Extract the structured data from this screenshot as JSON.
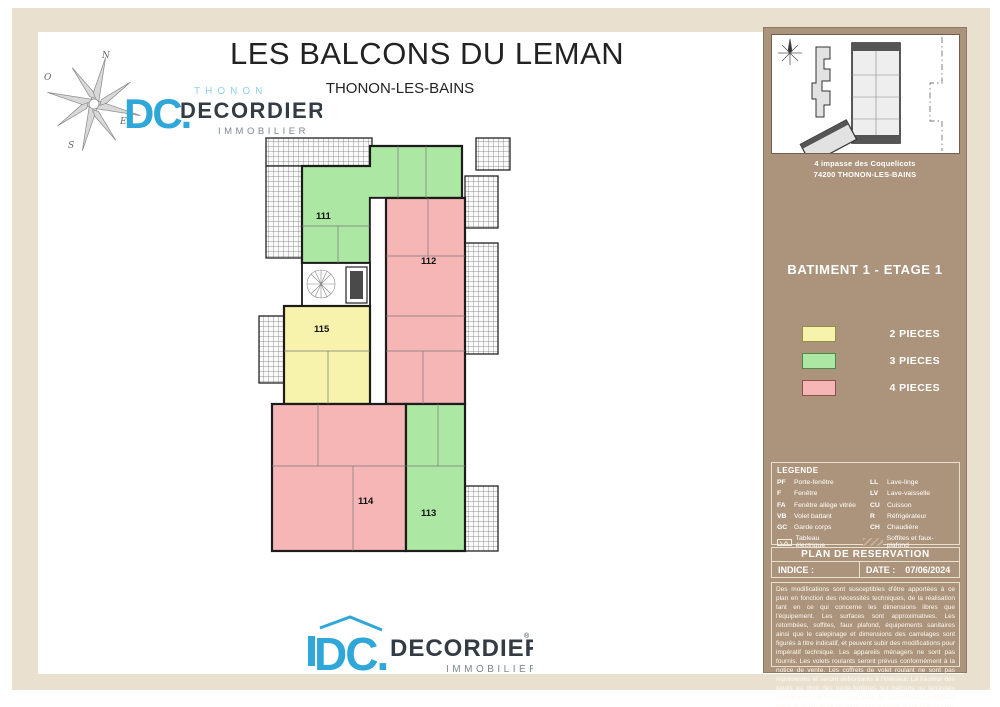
{
  "page": {
    "title": "LES BALCONS DU LEMAN",
    "subtitle": "THONON-LES-BAINS"
  },
  "brand": {
    "monogram": "DC.",
    "city": "THONON",
    "name": "DECORDIER",
    "registered": "®",
    "tagline": "IMMOBILIER",
    "compass": {
      "n": "N",
      "o": "O",
      "e": "E",
      "s": "S"
    },
    "blue": "#2fa7d9",
    "light_blue": "#8fd2e8",
    "dark": "#333c44",
    "gray": "#7d8790"
  },
  "sidebar": {
    "address_line1": "4 impasse des Coquelicots",
    "address_line2": "74200 THONON-LES-BAINS",
    "building_title": "BATIMENT 1 - ETAGE 1",
    "unit_types": [
      {
        "label": "2 PIECES",
        "color": "#f7f3ac",
        "border": "#8f8f45"
      },
      {
        "label": "3 PIECES",
        "color": "#ace8a4",
        "border": "#4d8a45"
      },
      {
        "label": "4 PIECES",
        "color": "#f6b6b6",
        "border": "#8f4d4d"
      }
    ],
    "legende": {
      "title": "LEGENDE",
      "items_left": [
        {
          "abbr": "PF",
          "label": "Porte-fenêtre"
        },
        {
          "abbr": "F",
          "label": "Fenêtre"
        },
        {
          "abbr": "FA",
          "label": "Fenêtre allège vitrée"
        },
        {
          "abbr": "VB",
          "label": "Volet battant"
        },
        {
          "abbr": "GC",
          "label": "Garde corps"
        }
      ],
      "items_right": [
        {
          "abbr": "LL",
          "label": "Lave-linge"
        },
        {
          "abbr": "LV",
          "label": "Lave-vaisselle"
        },
        {
          "abbr": "CU",
          "label": "Cuisson"
        },
        {
          "abbr": "R",
          "label": "Réfrigérateur"
        },
        {
          "abbr": "CH",
          "label": "Chaudière"
        }
      ],
      "elec_label": "Tableau électrique",
      "soffit_label": "Soffites et faux-plafond"
    },
    "reservation_title": "PLAN DE RESERVATION",
    "indice_label": "INDICE :",
    "date_label": "DATE :",
    "date_value": "07/06/2024",
    "disclaimer": "Des modifications sont susceptibles d'être apportées à ce plan en fonction des nécessités techniques, de la réalisation tant en ce qui concerne les dimensions libres que l'équipement. Les surfaces sont approximatives. Les retombées, soffites, faux plafond, équipements sanitaires ainsi que le calepinage et dimensions des carrelages sont figurés à titre indicatif, et peuvent subir des modifications pour impératif technique. Les appareils ménagers ne sont pas fournis. Les volets roulants seront prévus conformément à la notice de vente. Les coffrets de volet roulant ne sont pas représentés et seront débordants à l'intérieur. La hauteur des seuils au droit des porte-fenêtres sur balcons ou terrasses pourra varier de 5 à 35 cm à partir du sol intérieur. La hauteur entre le jardin et la terrasse pourra varier entre 0 et 60 cm. Les jardins ne seront pas nécessairement plats et pourront comporter des talus et des pentes."
  },
  "floorplan": {
    "units": [
      {
        "number": "111",
        "pieces": "3 PIECES",
        "color": "#ace8a4"
      },
      {
        "number": "112",
        "pieces": "4 PIECES",
        "color": "#f6b6b6"
      },
      {
        "number": "113",
        "pieces": "3 PIECES",
        "color": "#ace8a4"
      },
      {
        "number": "114",
        "pieces": "4 PIECES",
        "color": "#f6b6b6"
      },
      {
        "number": "115",
        "pieces": "2 PIECES",
        "color": "#f7f3ac"
      }
    ]
  },
  "colors": {
    "sidebar_bg": "#ac947c",
    "frame_beige": "#e9e0d0",
    "wall": "#1c1c1c"
  }
}
